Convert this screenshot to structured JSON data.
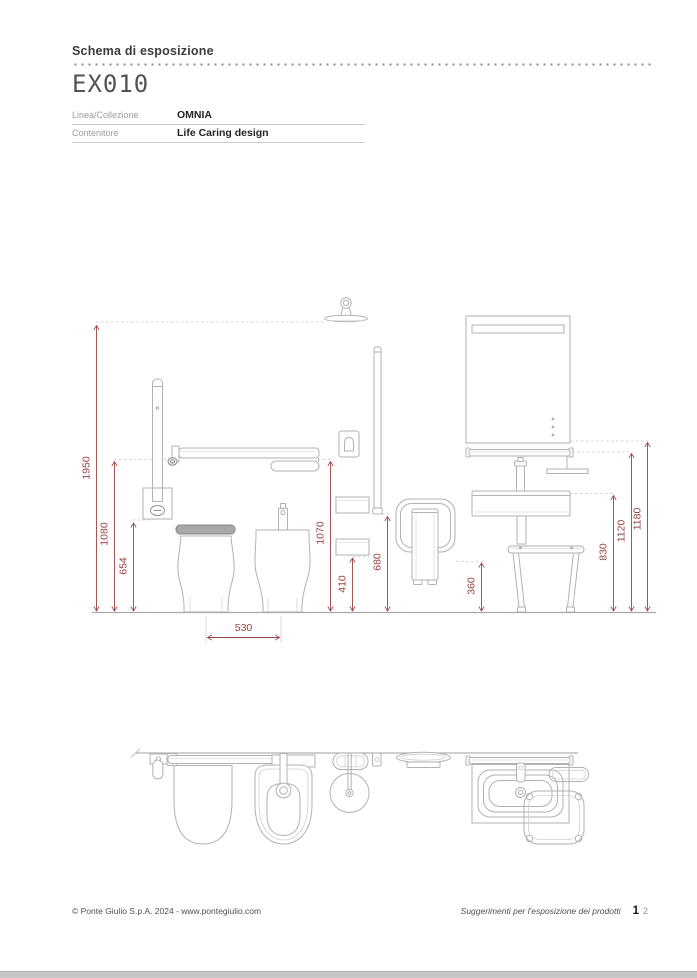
{
  "header": {
    "title": "Schema di esposizione",
    "code": "EX010",
    "table": {
      "rows": [
        {
          "label": "Linea/Collezione",
          "value": "OMNIA"
        },
        {
          "label": "Contenitore",
          "value": "Life Caring design"
        }
      ]
    }
  },
  "drawing": {
    "colors": {
      "dimension": "#9a4343",
      "line": "#b2b2b2"
    },
    "dims": [
      {
        "id": "shower-head-height",
        "value": "1950"
      },
      {
        "id": "grab-bar-height",
        "value": "1080"
      },
      {
        "id": "wall-plate-height",
        "value": "654"
      },
      {
        "id": "flip-up-bar-height",
        "value": "1070"
      },
      {
        "id": "shelf-height",
        "value": "410"
      },
      {
        "id": "rail-bottom-height",
        "value": "680"
      },
      {
        "id": "seat-height",
        "value": "360"
      },
      {
        "id": "washbasin-height",
        "value": "830"
      },
      {
        "id": "towel-bar-height",
        "value": "1120"
      },
      {
        "id": "mirror-bottom-height",
        "value": "1180"
      },
      {
        "id": "toilet-bidet-spacing",
        "value": "530"
      }
    ]
  },
  "footer": {
    "copyright": "© Ponte Giulio S.p.A.  2024 - www.pontegiulio.com",
    "note": "Suggerimenti per l'esposizione dei prodotti",
    "page_current": "1",
    "page_next": "2"
  }
}
